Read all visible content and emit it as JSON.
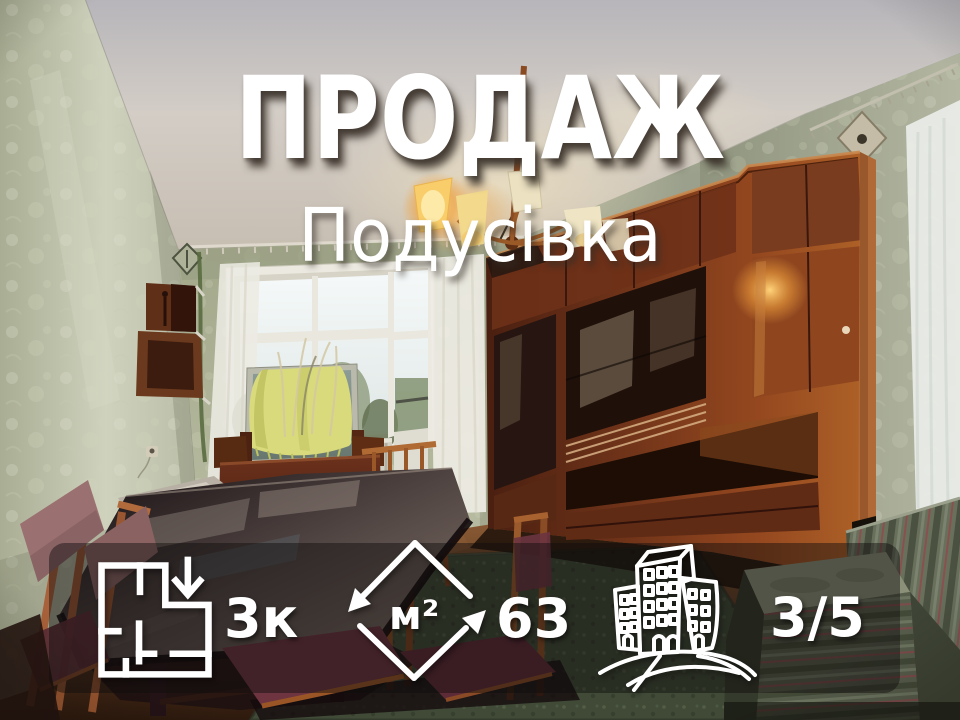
{
  "listing": {
    "deal_type": "ПРОДАЖ",
    "district": "Подусівка",
    "stats": [
      {
        "id": "rooms",
        "icon": "floor-plan-icon",
        "value": "3к"
      },
      {
        "id": "area",
        "icon": "area-arrows-icon",
        "unit": "м²",
        "value": "63"
      },
      {
        "id": "floor",
        "icon": "building-icon",
        "value": "3/5"
      }
    ]
  },
  "colors": {
    "text": "#ffffff",
    "band": "rgba(16,14,12,0.46)",
    "title_shadow": "rgba(56,48,40,0.85)"
  }
}
